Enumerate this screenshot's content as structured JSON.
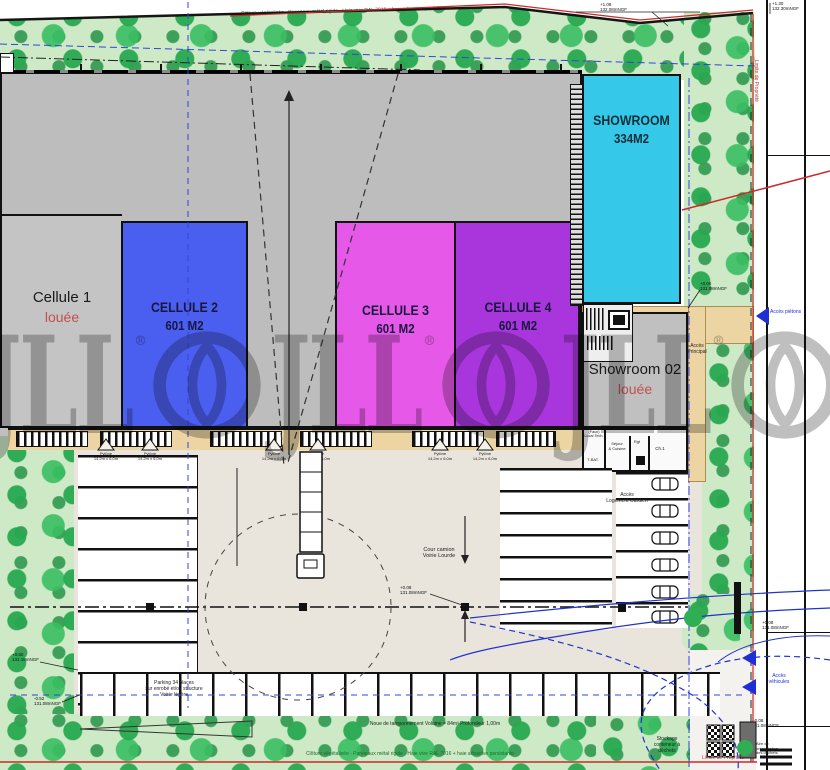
{
  "watermark": {
    "brand": "JLL",
    "reg": "®"
  },
  "cells": {
    "c1": {
      "title": "Cellule 1",
      "status": "louée"
    },
    "c2": {
      "title": "CELLULE 2",
      "area": "601 M2"
    },
    "c3": {
      "title": "CELLULE 3",
      "area": "601 M2"
    },
    "c4": {
      "title": "CELLULE 4",
      "area": "601 M2"
    },
    "showroom": {
      "title": "SHOWROOM",
      "area": "334M2"
    },
    "showroom02": {
      "title": "Showroom 02",
      "status": "louée"
    }
  },
  "labels": {
    "cour_camion_1": "Cour camion",
    "cour_camion_2": "Voirie Lourde",
    "parking_1": "Parking 34 places",
    "parking_2": "sur enrobé et/ou structure",
    "parking_3": "Voirie légère",
    "acces_pietons": "Accès piétons",
    "acces_vehicules_1": "Accès",
    "acces_vehicules_2": "véhicules",
    "acces_principal_1": "Accès",
    "acces_principal_2": "Principal",
    "acces_gardien_1": "Accès",
    "acces_gardien_2": "Logement Gardien",
    "stockage_1": "Stockage",
    "stockage_2": "conteneur à",
    "stockage_3": "déchets",
    "dechets_1": "Aire de",
    "dechets_2": "présentation",
    "dechets_3": "des déchets",
    "limite_propriete": "Limite de Propriété"
  },
  "notes": {
    "fence_top": "Clôture végétalisée - Panneaux métal rigide - Haie vive RAL 7016 + haie arbustive persistante",
    "fence_bottom": "Clôture végétalisée - Panneaux métal rigide - Haie vive RAL 7016 + haie arbustive persistante",
    "noue": "Noue de tamponnement Volume = 84m³ Profondeur 1,00m"
  },
  "rooms": {
    "r1a": "(Faux)",
    "r1b": "Local Tech.",
    "r2": "T-BAT.",
    "r3a": "Séjour",
    "r3b": "& Cuisine",
    "r4": "Rgt",
    "r5": "Ch.1"
  },
  "pylon": {
    "l1": "Pylône",
    "l2": "14,2m x 6,0m"
  },
  "callouts": {
    "tr1a": "+1.08",
    "tr1b": "132.08mNGF",
    "tr2a": "+1.30",
    "tr2b": "132.30mNGF",
    "mr1a": "+0.08",
    "mr1b": "131.08mNGF",
    "ct1a": "+0.08",
    "ct1b": "131.08mNGF",
    "bl1a": "+0.50",
    "bl1b": "131.18mNGF",
    "bl2a": "-0.52",
    "bl2b": "131.08mNGF",
    "br1a": "+0.08",
    "br1b": "131.08mNGF",
    "br2a": "+0.08",
    "br2b": "131.08mNGF"
  },
  "colors": {
    "cell2_blue": "#4a5ff0",
    "cell3_magenta": "#e658e8",
    "cell4_purple": "#a836dc",
    "showroom_cyan": "#35c8e8",
    "louee_red": "#c0504d",
    "property_line_red": "#cc2a2a",
    "access_blue": "#1f2fd4",
    "tree_green": "#35b65a",
    "strip_green": "#cde9c6",
    "building_gray": "#bdbdbd",
    "court_beige": "#e9e5dd",
    "walkway_tan": "#ecd5a2"
  }
}
